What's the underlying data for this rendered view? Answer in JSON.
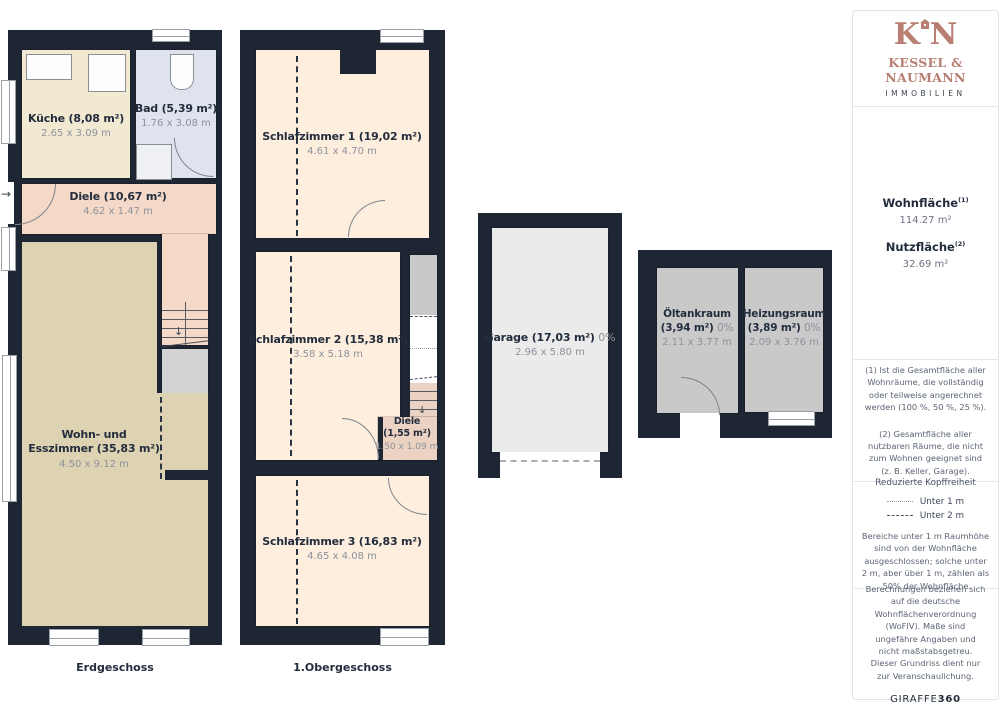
{
  "floors": {
    "eg": {
      "label": "Erdgeschoss",
      "kueche": {
        "name": "Küche (8,08 m²)",
        "dims": "2.65 x 3.09 m"
      },
      "bad": {
        "name": "Bad (5,39 m²)",
        "dims": "1.76 x 3.08 m"
      },
      "diele": {
        "name": "Diele (10,67 m²)",
        "dims": "4.62 x 1.47 m"
      },
      "wohnesszimmer": {
        "name_line1": "Wohn- und",
        "name_line2": "Esszimmer (35,83 m²)",
        "dims": "4.50 x 9.12 m"
      }
    },
    "og": {
      "label": "1.Obergeschoss",
      "schlafzimmer1": {
        "name": "Schlafzimmer 1 (19,02 m²)",
        "dims": "4.61 x 4.70 m"
      },
      "schlafzimmer2": {
        "name": "Schlafzimmer 2 (15,38 m²)",
        "dims": "3.58 x 5.18 m"
      },
      "diele": {
        "name": "Diele",
        "area": "(1,55 m²)",
        "dims": "1.50 x 1.09 m"
      },
      "schlafzimmer3": {
        "name": "Schlafzimmer 3 (16,83 m²)",
        "dims": "4.65 x 4.08 m"
      }
    },
    "garage": {
      "name": "Garage (17,03 m²)",
      "percent": "0%",
      "dims": "2.96 x 5.80 m"
    },
    "outbuilding": {
      "oeltankraum": {
        "name": "Öltankraum",
        "area": "(3,94 m²)",
        "percent": "0%",
        "dims": "2.11 x 3.77 m"
      },
      "heizungsraum": {
        "name": "Heizungsraum",
        "area": "(3,89 m²)",
        "percent": "0%",
        "dims": "2.09 x 3.76 m"
      }
    }
  },
  "sidebar": {
    "logo": {
      "letter_k": "K",
      "letter_n": "N",
      "brand": "KESSEL & NAUMANN",
      "subtitle": "IMMOBILIEN",
      "accent_color": "#b87f72"
    },
    "areas": {
      "wohnflaeche_label": "Wohnfläche",
      "wohnflaeche_sup": "(1)",
      "wohnflaeche_value": "114.27 m²",
      "nutzflaeche_label": "Nutzfläche",
      "nutzflaeche_sup": "(2)",
      "nutzflaeche_value": "32.69 m²"
    },
    "footnote1": "(1) Ist die Gesamtfläche aller Wohnräume, die vollständig oder teilweise angerechnet werden (100 %, 50 %, 25 %).",
    "footnote2": "(2) Gesamtfläche aller nutzbaren Räume, die nicht zum Wohnen geeignet sind (z. B. Keller, Garage).",
    "headroom": {
      "title": "Reduzierte Kopffreiheit",
      "legend1_label": "Unter 1 m",
      "legend2_label": "Unter 2 m",
      "note": "Bereiche unter 1 m Raumhöhe sind von der Wohnfläche ausgeschlossen; solche unter 2 m, aber über 1 m, zählen als 50% der Wohnfläche"
    },
    "disclaimer": "Berechnungen beziehen sich auf die deutsche Wohnflächenverordnung (WoFlV). Maße sind ungefähre Angaben und nicht maßstabsgetreu. Dieser Grundriss dient nur zur Veranschaulichung.",
    "credit_name": "GIRAFFE",
    "credit_number": "360"
  },
  "colors": {
    "wall": "#1e2533",
    "kueche_fill": "#f1e9d2",
    "bad_fill": "#dfe3ee",
    "diele_fill": "#f4d9c8",
    "wohnzimmer_fill": "#ddd3b3",
    "schlafzimmer_fill": "#fdeede",
    "stairs_fill": "#ecd2c3",
    "garage_fill": "#ebebeb",
    "utility_fill": "#c9c9c9",
    "landing_fill": "#d3d3d5",
    "label_dark": "#232d3d",
    "label_gray": "#8d929c",
    "logo_accent": "#b87f72"
  }
}
